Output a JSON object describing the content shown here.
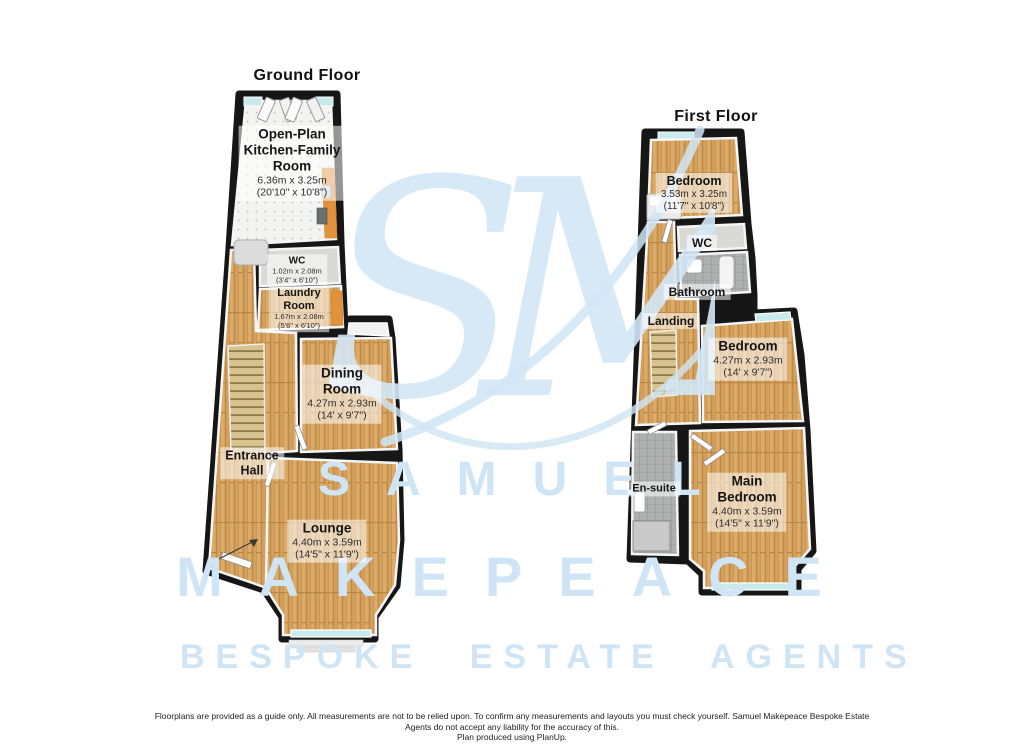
{
  "ground_floor": {
    "title": "Ground Floor",
    "rooms": {
      "kitchen": {
        "line1": "Open-Plan",
        "line2": "Kitchen-Family",
        "line3": "Room",
        "dim_m": "6.36m x 3.25m",
        "dim_ft": "(20'10\" x 10'8\")"
      },
      "wc": {
        "name": "WC",
        "dim_m": "1.02m x 2.08m",
        "dim_ft": "(3'4\" x 6'10\")"
      },
      "laundry": {
        "line1": "Laundry",
        "line2": "Room",
        "dim_m": "1.67m x 2.08m",
        "dim_ft": "(5'6\" x 6'10\")"
      },
      "dining": {
        "line1": "Dining",
        "line2": "Room",
        "dim_m": "4.27m x 2.93m",
        "dim_ft": "(14' x 9'7\")"
      },
      "hall": {
        "line1": "Entrance",
        "line2": "Hall"
      },
      "lounge": {
        "name": "Lounge",
        "dim_m": "4.40m x 3.59m",
        "dim_ft": "(14'5\" x 11'9\")"
      }
    }
  },
  "first_floor": {
    "title": "First Floor",
    "rooms": {
      "bedroom1": {
        "name": "Bedroom",
        "dim_m": "3.53m x 3.25m",
        "dim_ft": "(11'7\" x 10'8\")"
      },
      "wc": {
        "name": "WC"
      },
      "bathroom": {
        "name": "Bathroom"
      },
      "landing": {
        "name": "Landing"
      },
      "bedroom2": {
        "name": "Bedroom",
        "dim_m": "4.27m x 2.93m",
        "dim_ft": "(14' x 9'7\")"
      },
      "ensuite": {
        "name": "En-suite"
      },
      "main_bedroom": {
        "line1": "Main",
        "line2": "Bedroom",
        "dim_m": "4.40m x 3.59m",
        "dim_ft": "(14'5\" x 11'9\")"
      }
    }
  },
  "watermark": {
    "monogram": "SM",
    "row1": "SAMUEL",
    "row2": "MAKEPEACE",
    "row3": "BESPOKE ESTATE AGENTS",
    "color": "#cfe5f5"
  },
  "footer": {
    "line1": "Floorplans are provided as a guide only.  All measurements are not to be relied upon. To confirm any measurements and layouts you must check yourself.  Samuel Makepeace Bespoke Estate",
    "line2": "Agents do not accept any liability for the accuracy of this.",
    "line3": "Plan produced using PlanUp."
  },
  "colors": {
    "walls": "#161616",
    "wood_floor": "#d3a05e",
    "kitchen_tile": "#f3f3f2",
    "gray_tile": "#aeb0af",
    "window_glass": "#c8eaec",
    "counter_orange": "#e2913c",
    "watermark_blue": "#cfe5f5",
    "label_background": "rgba(255,255,255,0.55)"
  }
}
